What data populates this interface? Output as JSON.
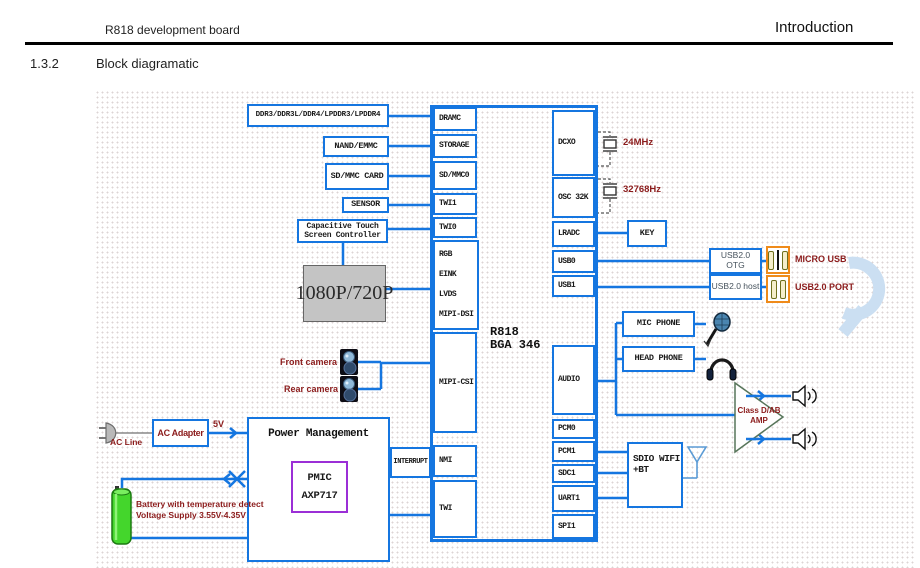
{
  "header": {
    "doc_title": "R818 development board",
    "page_title": "Introduction",
    "section_number": "1.3.2",
    "section_title": "Block diagramatic"
  },
  "chip": {
    "name_line1": "R818",
    "name_line2": "BGA 346",
    "left_ports": [
      "DRAMC",
      "STORAGE",
      "SD/MMC0",
      "TWI1",
      "TWI0"
    ],
    "display_ports": [
      "RGB",
      "EINK",
      "LVDS",
      "MIPI-DSI"
    ],
    "csi_port": "MIPI-CSI",
    "nmi_port": "NMI",
    "twi_port": "TWI",
    "right_ports": [
      "DCXO",
      "OSC 32K",
      "LRADC",
      "USB0",
      "USB1",
      "AUDIO",
      "PCM0",
      "PCM1",
      "SDC1",
      "UART1",
      "SPI1"
    ]
  },
  "memory": {
    "dram": "DDR3/DDR3L/DDR4/LPDDR3/LPDDR4",
    "flash": "NAND/EMMC",
    "sd_card": "SD/MMC CARD"
  },
  "sensors": {
    "sensor": "SENSOR",
    "touch_line1": "Capacitive Touch",
    "touch_line2": "Screen Controller"
  },
  "display": {
    "panel": "1080P/720P"
  },
  "camera": {
    "front": "Front camera",
    "rear": "Rear camera"
  },
  "clocks": {
    "main_crystal": "24MHz",
    "rtc_crystal": "32768Hz"
  },
  "input": {
    "key": "KEY"
  },
  "usb": {
    "otg": "USB2.0 OTG",
    "host": "USB2.0 host",
    "micro_label": "MICRO USB",
    "port_label": "USB2.0 PORT"
  },
  "audio": {
    "mic": "MIC PHONE",
    "headphone": "HEAD PHONE",
    "amp_line1": "Class D/AB",
    "amp_line2": "AMP"
  },
  "wireless": {
    "line1": "SDIO WIFI",
    "line2": "+BT"
  },
  "power": {
    "ac_line": "AC Line",
    "adapter": "AC Adapter",
    "rail": "5V",
    "pm_title": "Power Management",
    "pmic": "PMIC",
    "pmic_model": "AXP717",
    "interrupt": "INTERRUPT",
    "battery_line1": "Battery with temperature detect",
    "battery_line2": "Voltage Supply 3.55V-4.35V"
  },
  "colors": {
    "wire_blue": "#1576e0",
    "label_dark_red": "#8b1b1b",
    "pmic_purple": "#9b2fd6",
    "usb_orange": "#ef8b1a",
    "battery_green": "#44d62c",
    "display_gray": "#c4c4c4"
  },
  "icons": [
    "plug-icon",
    "battery-icon",
    "camera-icon",
    "crystal-icon",
    "mic-icon",
    "headphone-icon",
    "speaker-icon",
    "antenna-icon",
    "amp-triangle-icon",
    "usb-connector-icon",
    "watermark-swoosh"
  ]
}
